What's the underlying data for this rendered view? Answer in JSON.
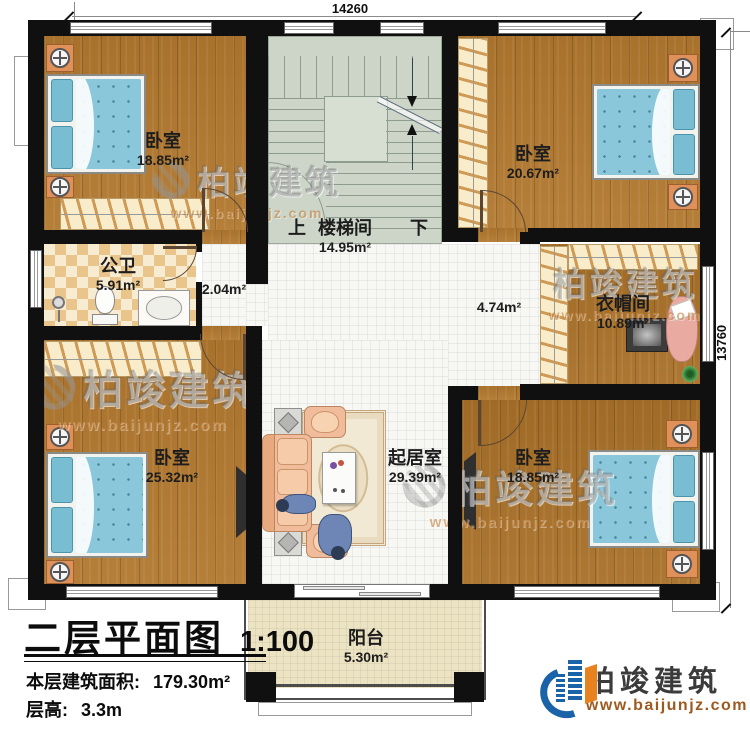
{
  "plan": {
    "dimensions": {
      "top": "14260",
      "right": "13760"
    },
    "rooms": {
      "bedroom_tl": {
        "name": "卧室",
        "area": "18.85m²"
      },
      "stair": {
        "up": "上",
        "name": "楼梯间",
        "area": "14.95m²",
        "down": "下"
      },
      "bedroom_tr": {
        "name": "卧室",
        "area": "20.67m²"
      },
      "bath": {
        "name": "公卫",
        "area": "5.91m²"
      },
      "hall_small": {
        "area": "2.04m²"
      },
      "hall_main": {
        "area": "4.74m²"
      },
      "cloak": {
        "name": "衣帽间",
        "area": "10.89m²"
      },
      "bedroom_bl": {
        "name": "卧室",
        "area": "25.32m²"
      },
      "living": {
        "name": "起居室",
        "area": "29.39m²"
      },
      "bedroom_br": {
        "name": "卧室",
        "area": "18.85m²"
      },
      "balcony": {
        "name": "阳台",
        "area": "5.30m²"
      }
    },
    "title_block": {
      "title": "二层平面图",
      "scale": "1:100",
      "area_label": "本层建筑面积:",
      "area_value": "179.30m²",
      "height_label": "层高:",
      "height_value": "3.3m"
    },
    "brand": {
      "name": "柏竣建筑",
      "url": "www.baijunjz.com"
    },
    "watermark": {
      "text": "柏竣建筑",
      "url": "www.baijunjz.com"
    },
    "colors": {
      "wall": "#101010",
      "wood": "#b1782f",
      "tile": "#f7f7f4",
      "stair": "#cdd5c9",
      "checker": "#eac58b",
      "balcony": "#ece3c3",
      "bed_blue": "#8ac7da",
      "nightstand_orange": "#e09059",
      "sofa_peach": "#f1bc9b",
      "logo_blue": "#1b63a8",
      "logo_orange": "#e8821e",
      "url_brown": "#9c5a20"
    }
  }
}
